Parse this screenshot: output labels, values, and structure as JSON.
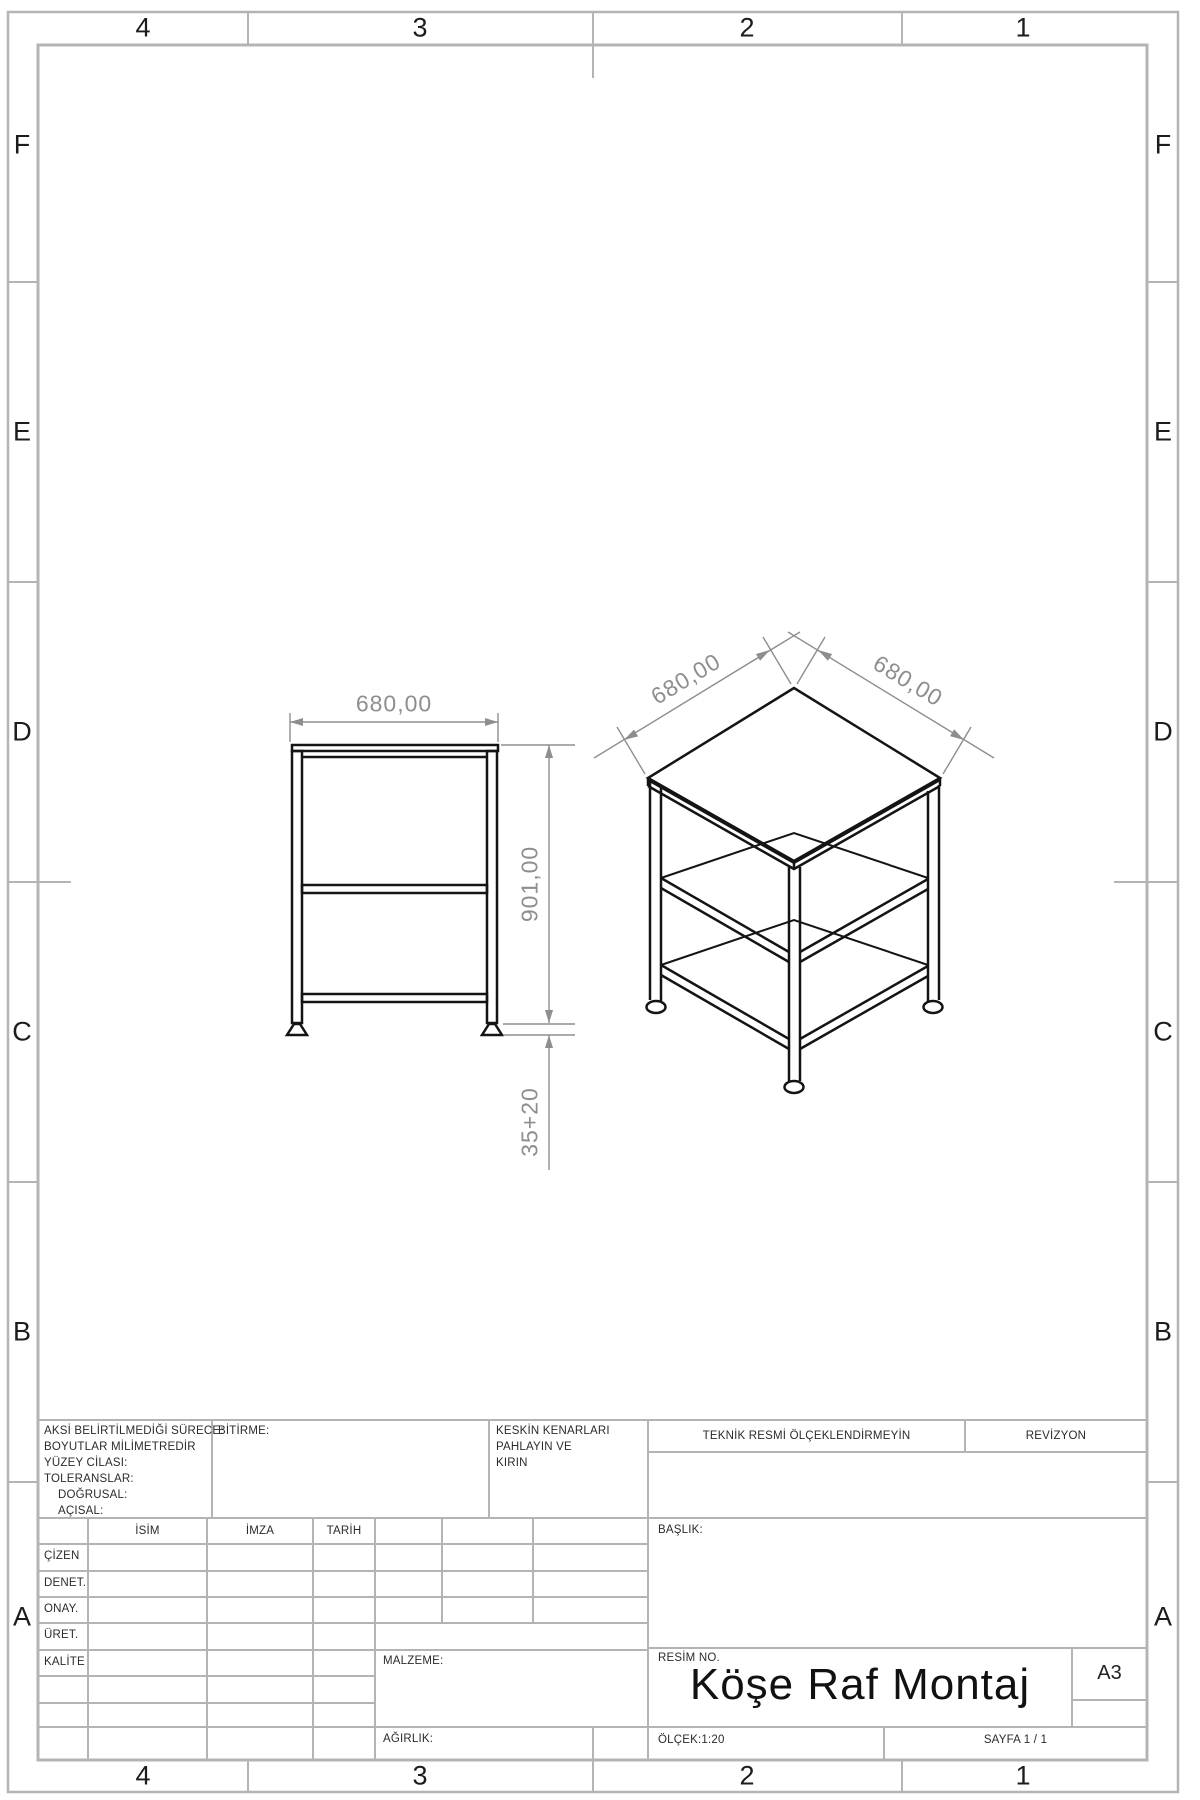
{
  "zones": {
    "columns": [
      "4",
      "3",
      "2",
      "1"
    ],
    "rows": [
      "F",
      "E",
      "D",
      "C",
      "B",
      "A"
    ]
  },
  "dimensions": {
    "front_width": "680,00",
    "front_height": "901,00",
    "front_foot": "35+20",
    "iso_left": "680,00",
    "iso_right": "680,00"
  },
  "title_block": {
    "tolerance_notes": [
      "AKSİ BELİRTİLMEDİĞİ SÜRECE:",
      "BOYUTLAR MİLİMETREDİR",
      "YÜZEY CİLASI:",
      "TOLERANSLAR:",
      "DOĞRUSAL:",
      "AÇISAL:"
    ],
    "finish_label": "BİTİRME:",
    "edges_note": [
      "KESKİN KENARLARI",
      "PAHLAYIN VE",
      "KIRIN"
    ],
    "do_not_scale": "TEKNİK RESMİ ÖLÇEKLENDİRMEYİN",
    "revision_label": "REVİZYON",
    "title_label": "BAŞLIK:",
    "name_header": "İSİM",
    "signature_header": "İMZA",
    "date_header": "TARİH",
    "approval_rows": [
      "ÇİZEN",
      "DENET.",
      "ONAY.",
      "ÜRET.",
      "KALİTE"
    ],
    "material_label": "MALZEME:",
    "weight_label": "AĞIRLIK:",
    "drawing_no_label": "RESİM NO.",
    "drawing_title": "Köşe Raf Montaj",
    "paper_size": "A3",
    "scale": "ÖLÇEK:1:20",
    "sheet": "SAYFA 1 / 1"
  }
}
